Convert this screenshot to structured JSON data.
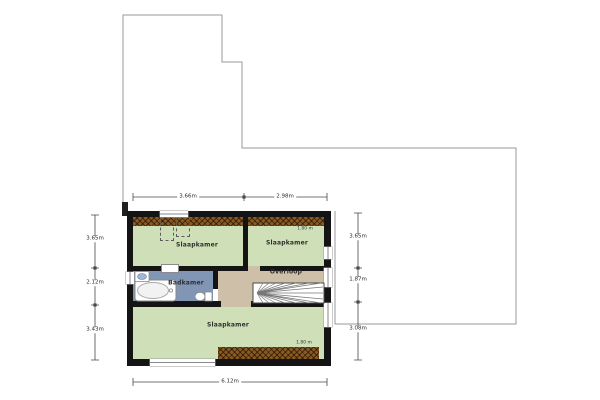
{
  "plan": {
    "rooms": {
      "bedroom_top_left": {
        "label": "Slaapkamer"
      },
      "bedroom_top_right": {
        "label": "Slaapkamer",
        "headroom": "1.80 m"
      },
      "bathroom": {
        "label": "Badkamer"
      },
      "landing": {
        "label": "Overloop"
      },
      "bedroom_bottom": {
        "label": "Slaapkamer",
        "headroom": "1.80 m"
      }
    },
    "dimensions": {
      "top": {
        "left": "3.66m",
        "right": "2.98m"
      },
      "bottom": {
        "total": "6.12m"
      },
      "left": {
        "top": "3.65m",
        "middle": "2.12m",
        "bottom": "3.43m"
      },
      "right": {
        "top": "3.65m",
        "middle": "1.87m",
        "bottom": "3.08m"
      }
    },
    "colors": {
      "floor_green": "#cfe0b8",
      "floor_blue": "#8096b4",
      "floor_tan": "#cec0a8",
      "wall": "#141414",
      "hatch_brown": "#8a5a22",
      "outline_gray": "#9a9a9a"
    }
  }
}
